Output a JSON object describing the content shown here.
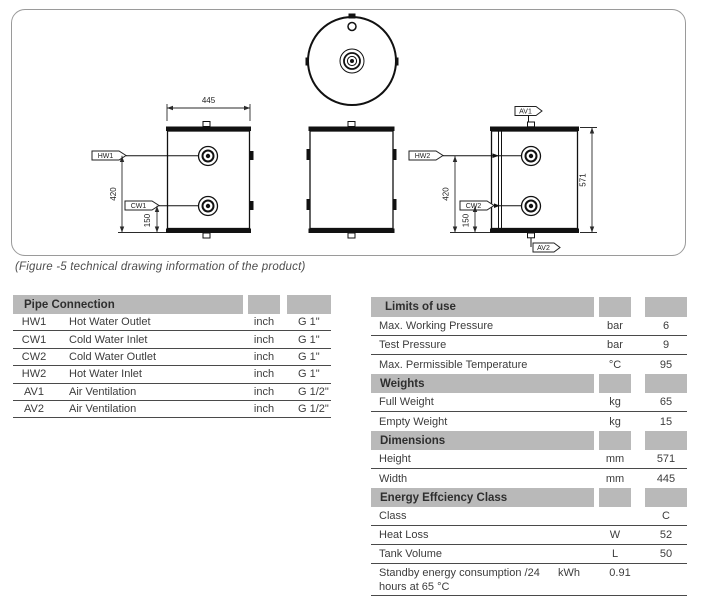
{
  "figure": {
    "caption": "(Figure -5 technical drawing information of the product)",
    "labels": {
      "hw1": "HW1",
      "cw1": "CW1",
      "hw2": "HW2",
      "cw2": "CW2",
      "av1": "AV1",
      "av2": "AV2"
    },
    "dims": {
      "width_445": "445",
      "height_571": "571",
      "d420": "420",
      "d150": "150"
    }
  },
  "pipe_table": {
    "title": "Pipe Connection",
    "rows": [
      {
        "code": "HW1",
        "label": "Hot Water Outlet",
        "unit": "inch",
        "value": "G 1\""
      },
      {
        "code": "CW1",
        "label": "Cold Water Inlet",
        "unit": "inch",
        "value": "G 1\""
      },
      {
        "code": "CW2",
        "label": "Cold Water Outlet",
        "unit": "inch",
        "value": "G 1\""
      },
      {
        "code": "HW2",
        "label": "Hot Water Inlet",
        "unit": "inch",
        "value": "G 1\""
      },
      {
        "code": "AV1",
        "label": "Air Ventilation",
        "unit": "inch",
        "value": "G 1/2\""
      },
      {
        "code": "AV2",
        "label": "Air Ventilation",
        "unit": "inch",
        "value": "G 1/2\""
      }
    ]
  },
  "limits_table": {
    "rows": [
      {
        "type": "header",
        "label": "Limits of use"
      },
      {
        "type": "row",
        "label": "Max. Working Pressure",
        "unit": "bar",
        "value": "6"
      },
      {
        "type": "row",
        "label": "Test Pressure",
        "unit": "bar",
        "value": "9"
      },
      {
        "type": "row",
        "label": "Max. Permissible Temperature",
        "unit": "°C",
        "value": "95"
      },
      {
        "type": "header",
        "label": "Weights"
      },
      {
        "type": "row",
        "label": "Full Weight",
        "unit": "kg",
        "value": "65"
      },
      {
        "type": "row",
        "label": "Empty Weight",
        "unit": "kg",
        "value": "15"
      },
      {
        "type": "header",
        "label": "Dimensions"
      },
      {
        "type": "row",
        "label": "Height",
        "unit": "mm",
        "value": "571"
      },
      {
        "type": "row",
        "label": "Width",
        "unit": "mm",
        "value": "445"
      },
      {
        "type": "header",
        "label": "Energy Effciency Class"
      },
      {
        "type": "row",
        "label": "Class",
        "unit": "",
        "value": "C"
      },
      {
        "type": "row",
        "label": "Heat Loss",
        "unit": "W",
        "value": "52"
      },
      {
        "type": "row",
        "label": "Tank Volume",
        "unit": "L",
        "value": "50"
      },
      {
        "type": "row",
        "label": "Standby energy consumption /24 hours at 65 °C",
        "unit": "kWh",
        "value": "0.91"
      }
    ]
  },
  "colors": {
    "header_bg": "#b9b9b9",
    "rule_line": "#4a4a4a",
    "text": "#3c3c3c",
    "drawing_line": "#1a1a1a",
    "figure_border": "#9a9a9a"
  }
}
